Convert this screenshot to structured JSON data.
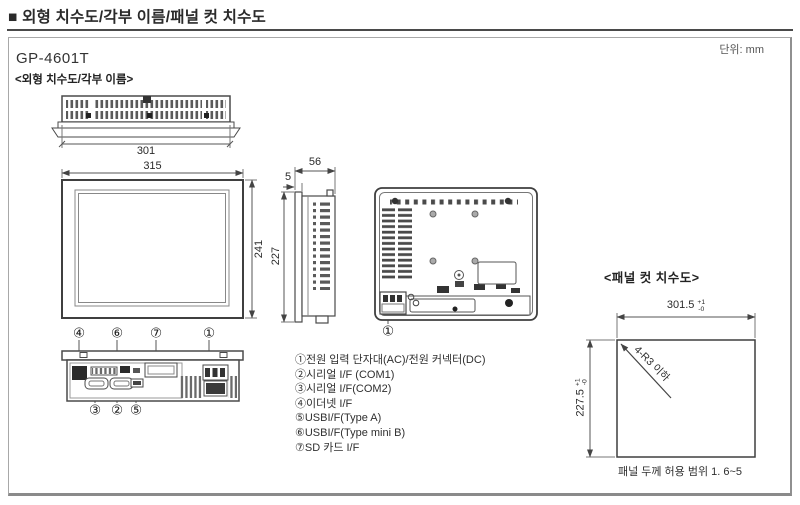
{
  "header": {
    "title": "■ 외형 치수도/각부 이름/패널 컷 치수도"
  },
  "sheet": {
    "unit_label": "단위: mm",
    "model": "GP-4601T",
    "outline_section_title": "<외형 치수도/각부 이름>",
    "panelcut_section_title": "<패널 컷 치수도>"
  },
  "outline": {
    "top_width": "301",
    "front_width": "315",
    "front_height": "241",
    "depth": "56",
    "bezel_thickness": "5",
    "side_height": "227",
    "callouts_front_bottom": [
      "④",
      "⑥",
      "⑦",
      "①"
    ],
    "callouts_under_bottom": [
      "③",
      "②",
      "⑤"
    ],
    "callout_rear": "①"
  },
  "legend": {
    "items": [
      "①전원 입력 단자대(AC)/전원 커넥터(DC)",
      "②시리얼 I/F (COM1)",
      "③시리얼 I/F(COM2)",
      "④이더넷 I/F",
      "⑤USBI/F(Type A)",
      "⑥USBI/F(Type mini B)",
      "⑦SD 카드 I/F"
    ]
  },
  "panel_cut": {
    "width": "301.5",
    "width_tol_plus": "+1",
    "width_tol_minus": "-0",
    "height": "227.5",
    "height_tol_plus": "+1",
    "height_tol_minus": "-0",
    "corner_note": "4-R3 이하",
    "thickness_note": "패널 두께 허용 범위 1. 6~5"
  },
  "colors": {
    "line": "#4a4a4a",
    "text": "#333333",
    "frame_border": "#a8a8a8"
  }
}
